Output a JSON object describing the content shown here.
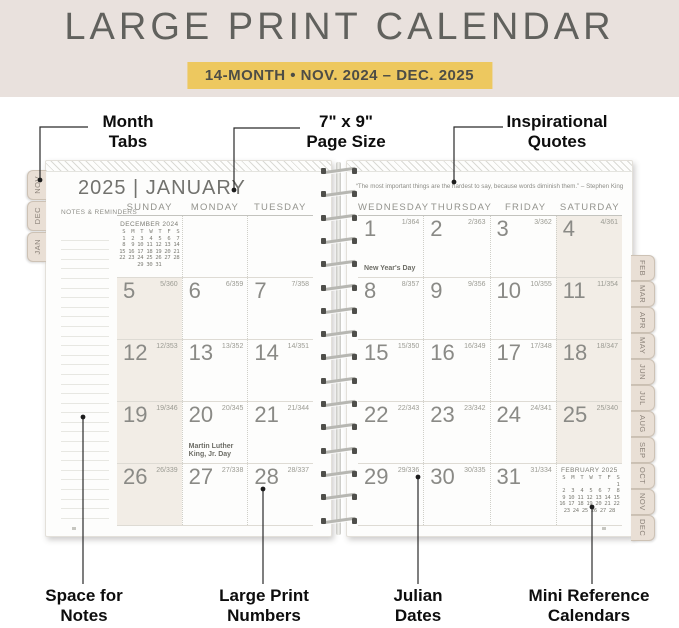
{
  "colors": {
    "header_bg": "#e9e1dd",
    "accent": "#edc85f",
    "weekend_shade": "#f2ede6",
    "tab_bg": "#e9dfd5"
  },
  "header": {
    "title": "LARGE PRINT CALENDAR",
    "badge": "14-MONTH  •  NOV. 2024 – DEC. 2025"
  },
  "callouts": {
    "month_tabs": {
      "line1": "Month",
      "line2": "Tabs"
    },
    "page_size": {
      "line1": "7\" x 9\"",
      "line2": "Page Size"
    },
    "inspirational": {
      "line1": "Inspirational",
      "line2": "Quotes"
    },
    "space_notes": {
      "line1": "Space for",
      "line2": "Notes"
    },
    "large_print": {
      "line1": "Large Print",
      "line2": "Numbers"
    },
    "julian": {
      "line1": "Julian",
      "line2": "Dates"
    },
    "mini_ref": {
      "line1": "Mini Reference",
      "line2": "Calendars"
    }
  },
  "spread": {
    "left_tabs": [
      "NOV",
      "DEC",
      "JAN"
    ],
    "right_tabs": [
      "FEB",
      "MAR",
      "APR",
      "MAY",
      "JUN",
      "JUL",
      "AUG",
      "SEP",
      "OCT",
      "NOV",
      "DEC"
    ],
    "left_page": {
      "title": "2025 | JANUARY",
      "notes_label": "NOTES & REMINDERS",
      "day_headers": [
        "SUNDAY",
        "MONDAY",
        "TUESDAY"
      ],
      "mini_calendar": {
        "title": "DECEMBER 2024",
        "lines": [
          " S  M  T  W  T  F  S",
          " 1  2  3  4  5  6  7",
          " 8  9 10 11 12 13 14",
          "15 16 17 18 19 20 21",
          "22 23 24 25 26 27 28",
          "29 30 31"
        ]
      },
      "weeks": [
        [
          {
            "day": "",
            "julian": ""
          },
          {
            "day": "",
            "julian": ""
          },
          {
            "day": "",
            "julian": ""
          }
        ],
        [
          {
            "day": "5",
            "julian": "5/360"
          },
          {
            "day": "6",
            "julian": "6/359"
          },
          {
            "day": "7",
            "julian": "7/358"
          }
        ],
        [
          {
            "day": "12",
            "julian": "12/353"
          },
          {
            "day": "13",
            "julian": "13/352"
          },
          {
            "day": "14",
            "julian": "14/351"
          }
        ],
        [
          {
            "day": "19",
            "julian": "19/346"
          },
          {
            "day": "20",
            "julian": "20/345",
            "note": "Martin Luther King, Jr. Day"
          },
          {
            "day": "21",
            "julian": "21/344"
          }
        ],
        [
          {
            "day": "26",
            "julian": "26/339"
          },
          {
            "day": "27",
            "julian": "27/338"
          },
          {
            "day": "28",
            "julian": "28/337"
          }
        ]
      ]
    },
    "right_page": {
      "quote": "“The most important things are the hardest to say, because words diminish them.”  – Stephen King",
      "day_headers": [
        "WEDNESDAY",
        "THURSDAY",
        "FRIDAY",
        "SATURDAY"
      ],
      "mini_calendar": {
        "title": "FEBRUARY 2025",
        "lines": [
          " S  M  T  W  T  F  S",
          "                   1",
          " 2  3  4  5  6  7  8",
          " 9 10 11 12 13 14 15",
          "16 17 18 19 20 21 22",
          "23 24 25 26 27 28"
        ]
      },
      "weeks": [
        [
          {
            "day": "1",
            "julian": "1/364",
            "note": "New Year's Day"
          },
          {
            "day": "2",
            "julian": "2/363"
          },
          {
            "day": "3",
            "julian": "3/362"
          },
          {
            "day": "4",
            "julian": "4/361"
          }
        ],
        [
          {
            "day": "8",
            "julian": "8/357"
          },
          {
            "day": "9",
            "julian": "9/356"
          },
          {
            "day": "10",
            "julian": "10/355"
          },
          {
            "day": "11",
            "julian": "11/354"
          }
        ],
        [
          {
            "day": "15",
            "julian": "15/350"
          },
          {
            "day": "16",
            "julian": "16/349"
          },
          {
            "day": "17",
            "julian": "17/348"
          },
          {
            "day": "18",
            "julian": "18/347"
          }
        ],
        [
          {
            "day": "22",
            "julian": "22/343"
          },
          {
            "day": "23",
            "julian": "23/342"
          },
          {
            "day": "24",
            "julian": "24/341"
          },
          {
            "day": "25",
            "julian": "25/340"
          }
        ],
        [
          {
            "day": "29",
            "julian": "29/336"
          },
          {
            "day": "30",
            "julian": "30/335"
          },
          {
            "day": "31",
            "julian": "31/334"
          },
          {
            "day": "",
            "julian": ""
          }
        ]
      ]
    }
  }
}
